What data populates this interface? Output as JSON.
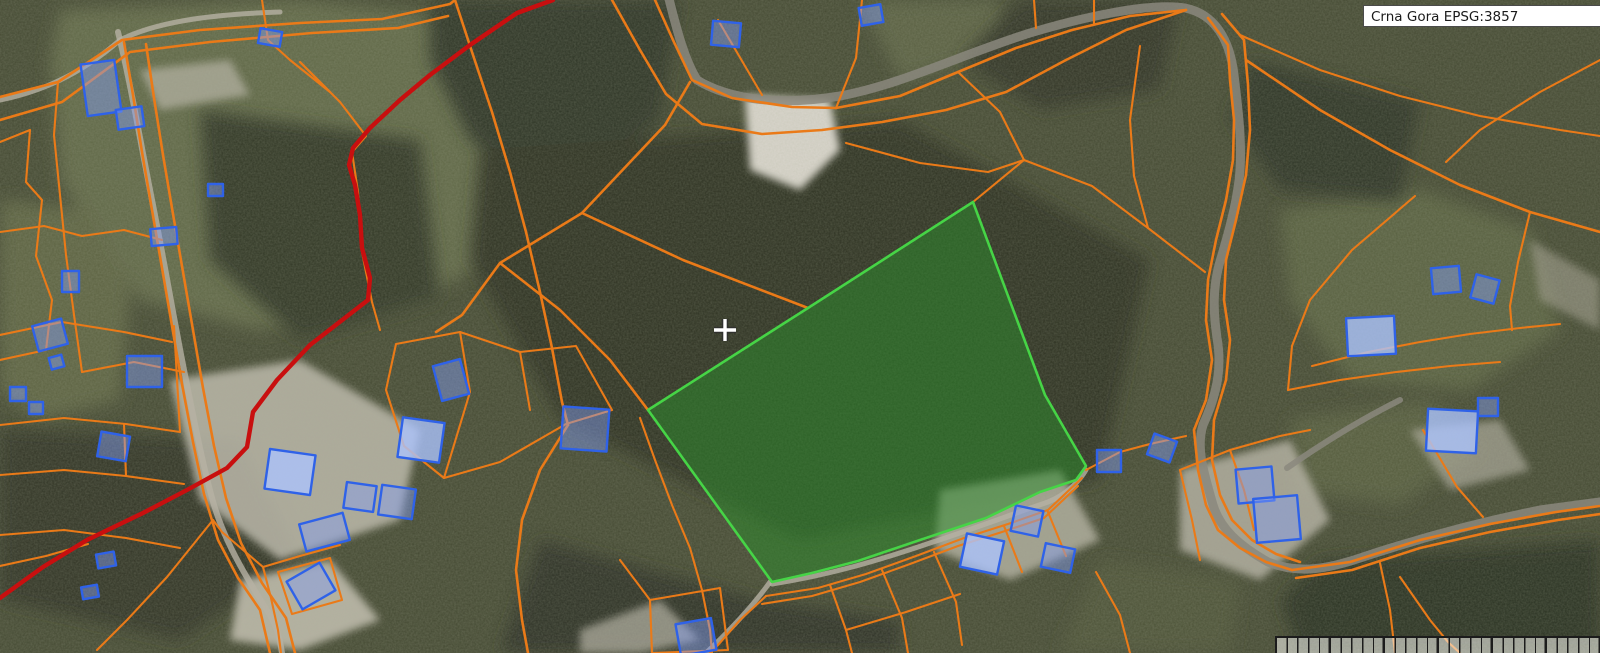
{
  "header": {
    "projection_label": "Crna Gora EPSG:3857",
    "region_name": "Crna Gora",
    "projection_code": "EPSG:3857"
  },
  "colors": {
    "parcel-boundary": "#EA7A18",
    "marked-road": "#C80F0F",
    "building-stroke": "#2F62E8",
    "building-fill": "rgba(130,158,245,0.45)",
    "building-fill-bright": "rgba(172,196,255,0.78)",
    "selected-parcel-stroke": "#46D446",
    "selected-parcel-fill": "rgba(44,140,44,0.52)",
    "crosshair": "#FFFFFF"
  }
}
